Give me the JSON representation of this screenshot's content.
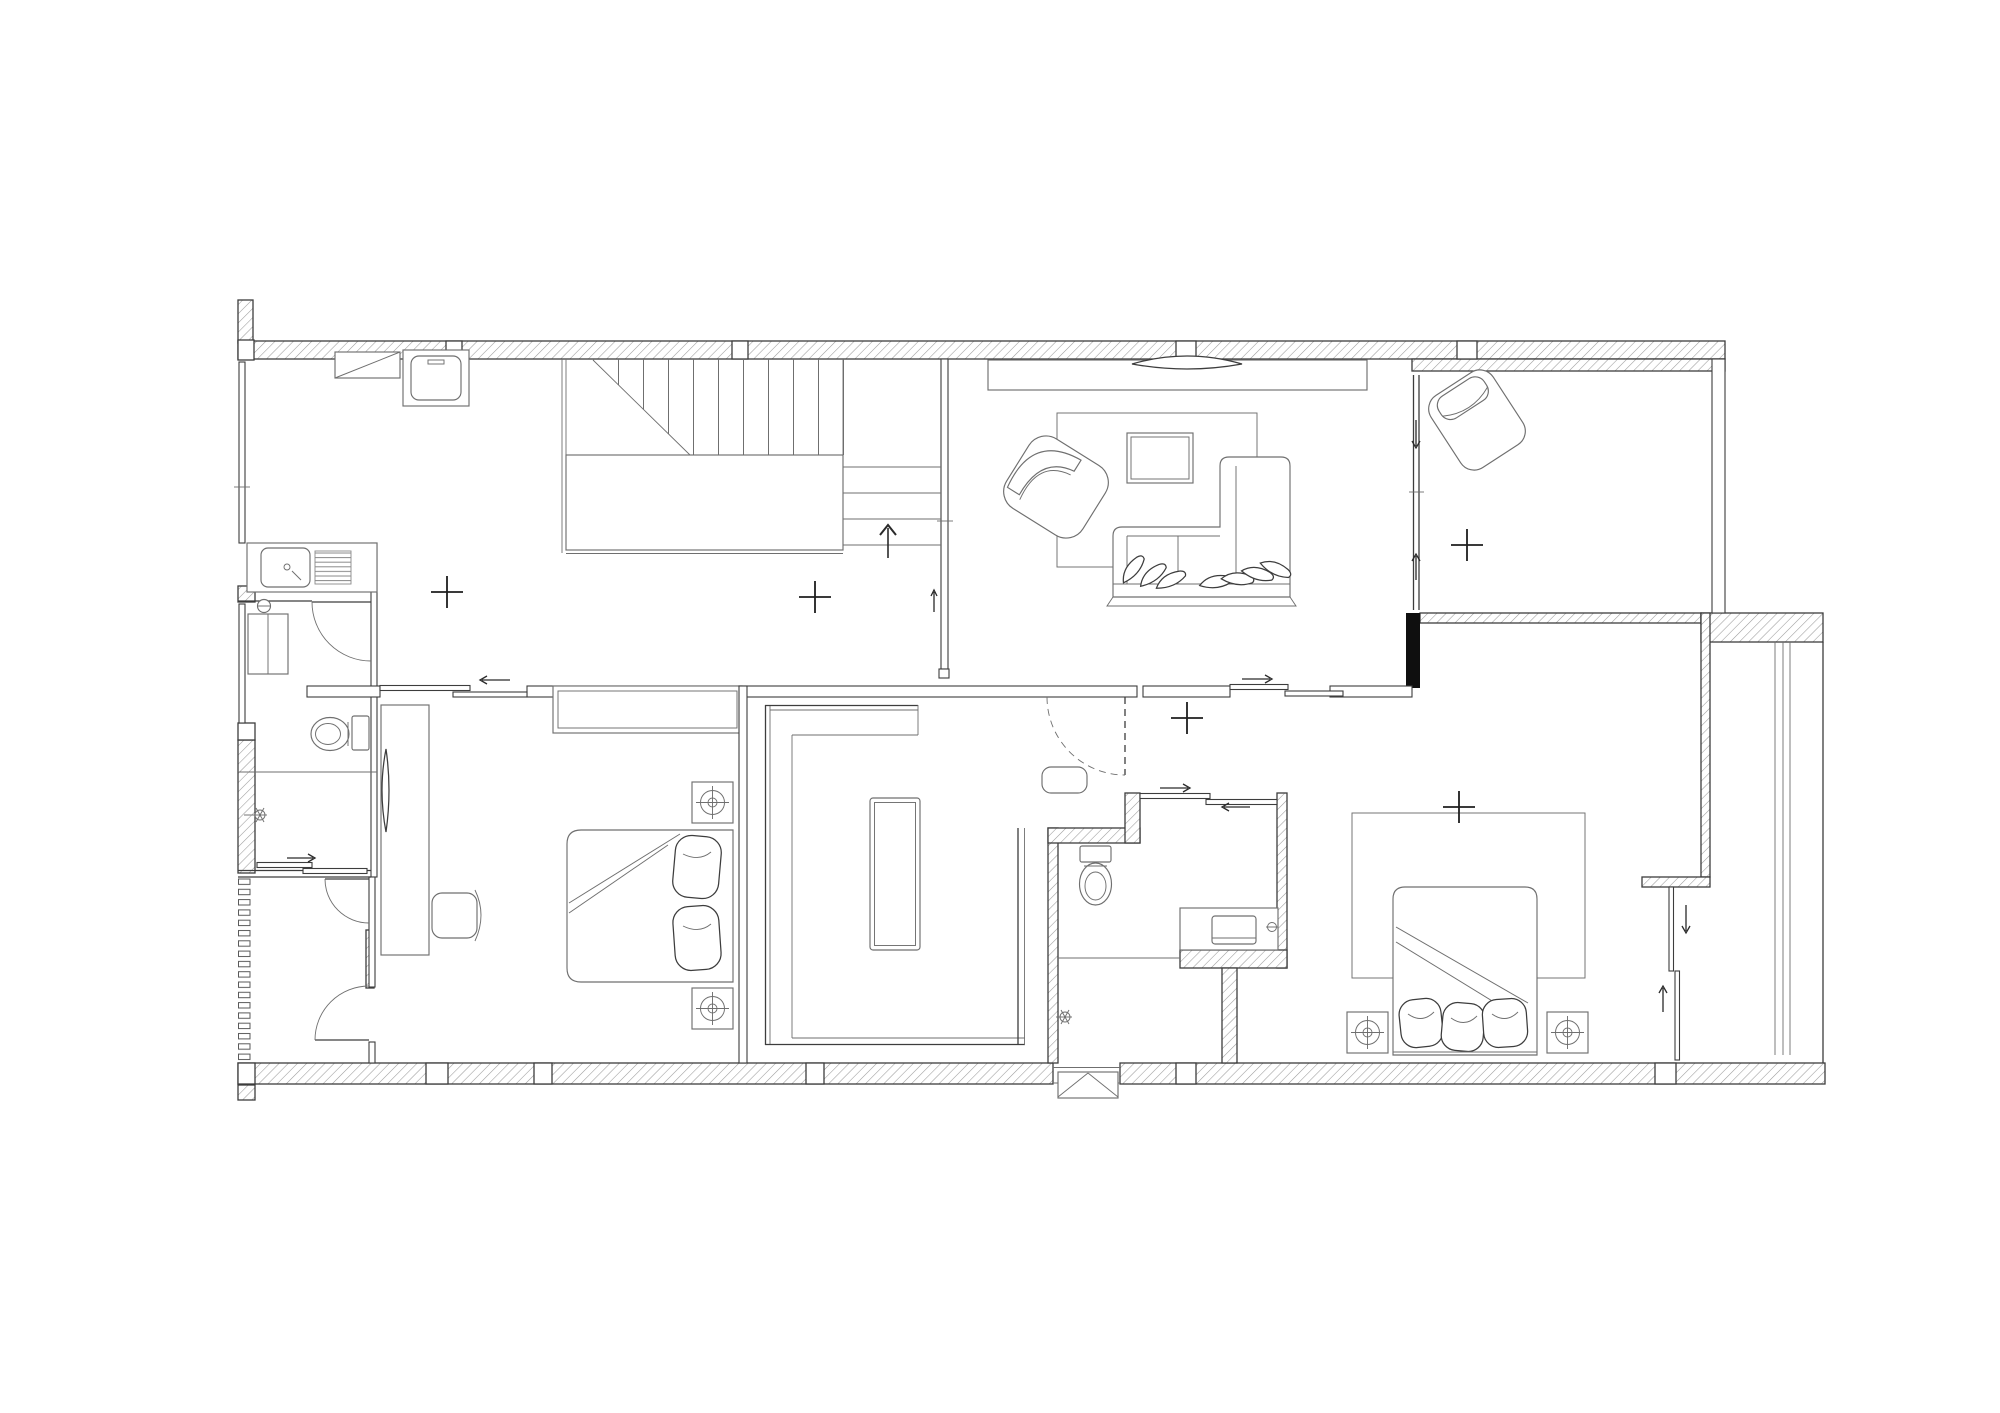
{
  "document": {
    "kind": "architectural floor plan, black-and-white line drawing",
    "floor": "upper level reached by U-shaped stair",
    "visible_text": [],
    "canvas": {
      "width": 2000,
      "height": 1413,
      "background": "#ffffff"
    }
  },
  "colors": {
    "background": "#ffffff",
    "line": "#3d3d3d",
    "line_light": "#6f6f6f",
    "hatch": "#9b9b9b",
    "black_accent": "#0f0f0f",
    "mark": "#1e1e1e"
  },
  "rooms": [
    {
      "id": "hall-kitchenette",
      "fixtures": [
        "wall-cabinet",
        "washing-machine",
        "kitchen-sink-counter",
        "staircase"
      ]
    },
    {
      "id": "living-room",
      "fixtures": [
        "tv-console",
        "tv",
        "rug",
        "coffee-table",
        "armchair",
        "sectional-sofa"
      ]
    },
    {
      "id": "balcony",
      "fixtures": [
        "lounge-chair",
        "sliding-glass-door"
      ]
    },
    {
      "id": "bathroom-1",
      "fixtures": [
        "sink-counter-with-drainboard",
        "water-heater",
        "toilet",
        "shower-head",
        "shower-sliding-door",
        "hinged-door"
      ]
    },
    {
      "id": "drying-vestibule",
      "fixtures": [
        "louvered-screen",
        "hinged-door-north",
        "hinged-door-south"
      ]
    },
    {
      "id": "bedroom-2",
      "fixtures": [
        "double-bed",
        "pillows",
        "nightstand-lamp-north",
        "nightstand-lamp-south",
        "desk-counter",
        "tv",
        "chair",
        "wardrobe",
        "sliding-entry-door"
      ]
    },
    {
      "id": "walk-in-closet",
      "fixtures": [
        "u-shaped-wardrobe",
        "island-dresser"
      ]
    },
    {
      "id": "master-hall",
      "fixtures": [
        "pouf",
        "dashed-hinged-door"
      ]
    },
    {
      "id": "master-bathroom",
      "fixtures": [
        "toilet",
        "vanity-sink",
        "shower-head",
        "sliding-door",
        "vent-step-box"
      ]
    },
    {
      "id": "master-bedroom",
      "fixtures": [
        "double-bed",
        "pillows",
        "nightstand-lamp-west",
        "nightstand-lamp-east",
        "rug",
        "sliding-door-to-closet-corridor",
        "sliding-entry-door"
      ]
    },
    {
      "id": "closet-corridor",
      "fixtures": [
        "wardrobe-run"
      ]
    }
  ],
  "annotations": {
    "center_marks": [
      [
        447,
        592
      ],
      [
        815,
        597
      ],
      [
        1187,
        718
      ],
      [
        1459,
        807
      ],
      [
        1467,
        545
      ]
    ],
    "stair_direction": "up",
    "hinged_door_count": 5,
    "sliding_door_count": 7
  }
}
